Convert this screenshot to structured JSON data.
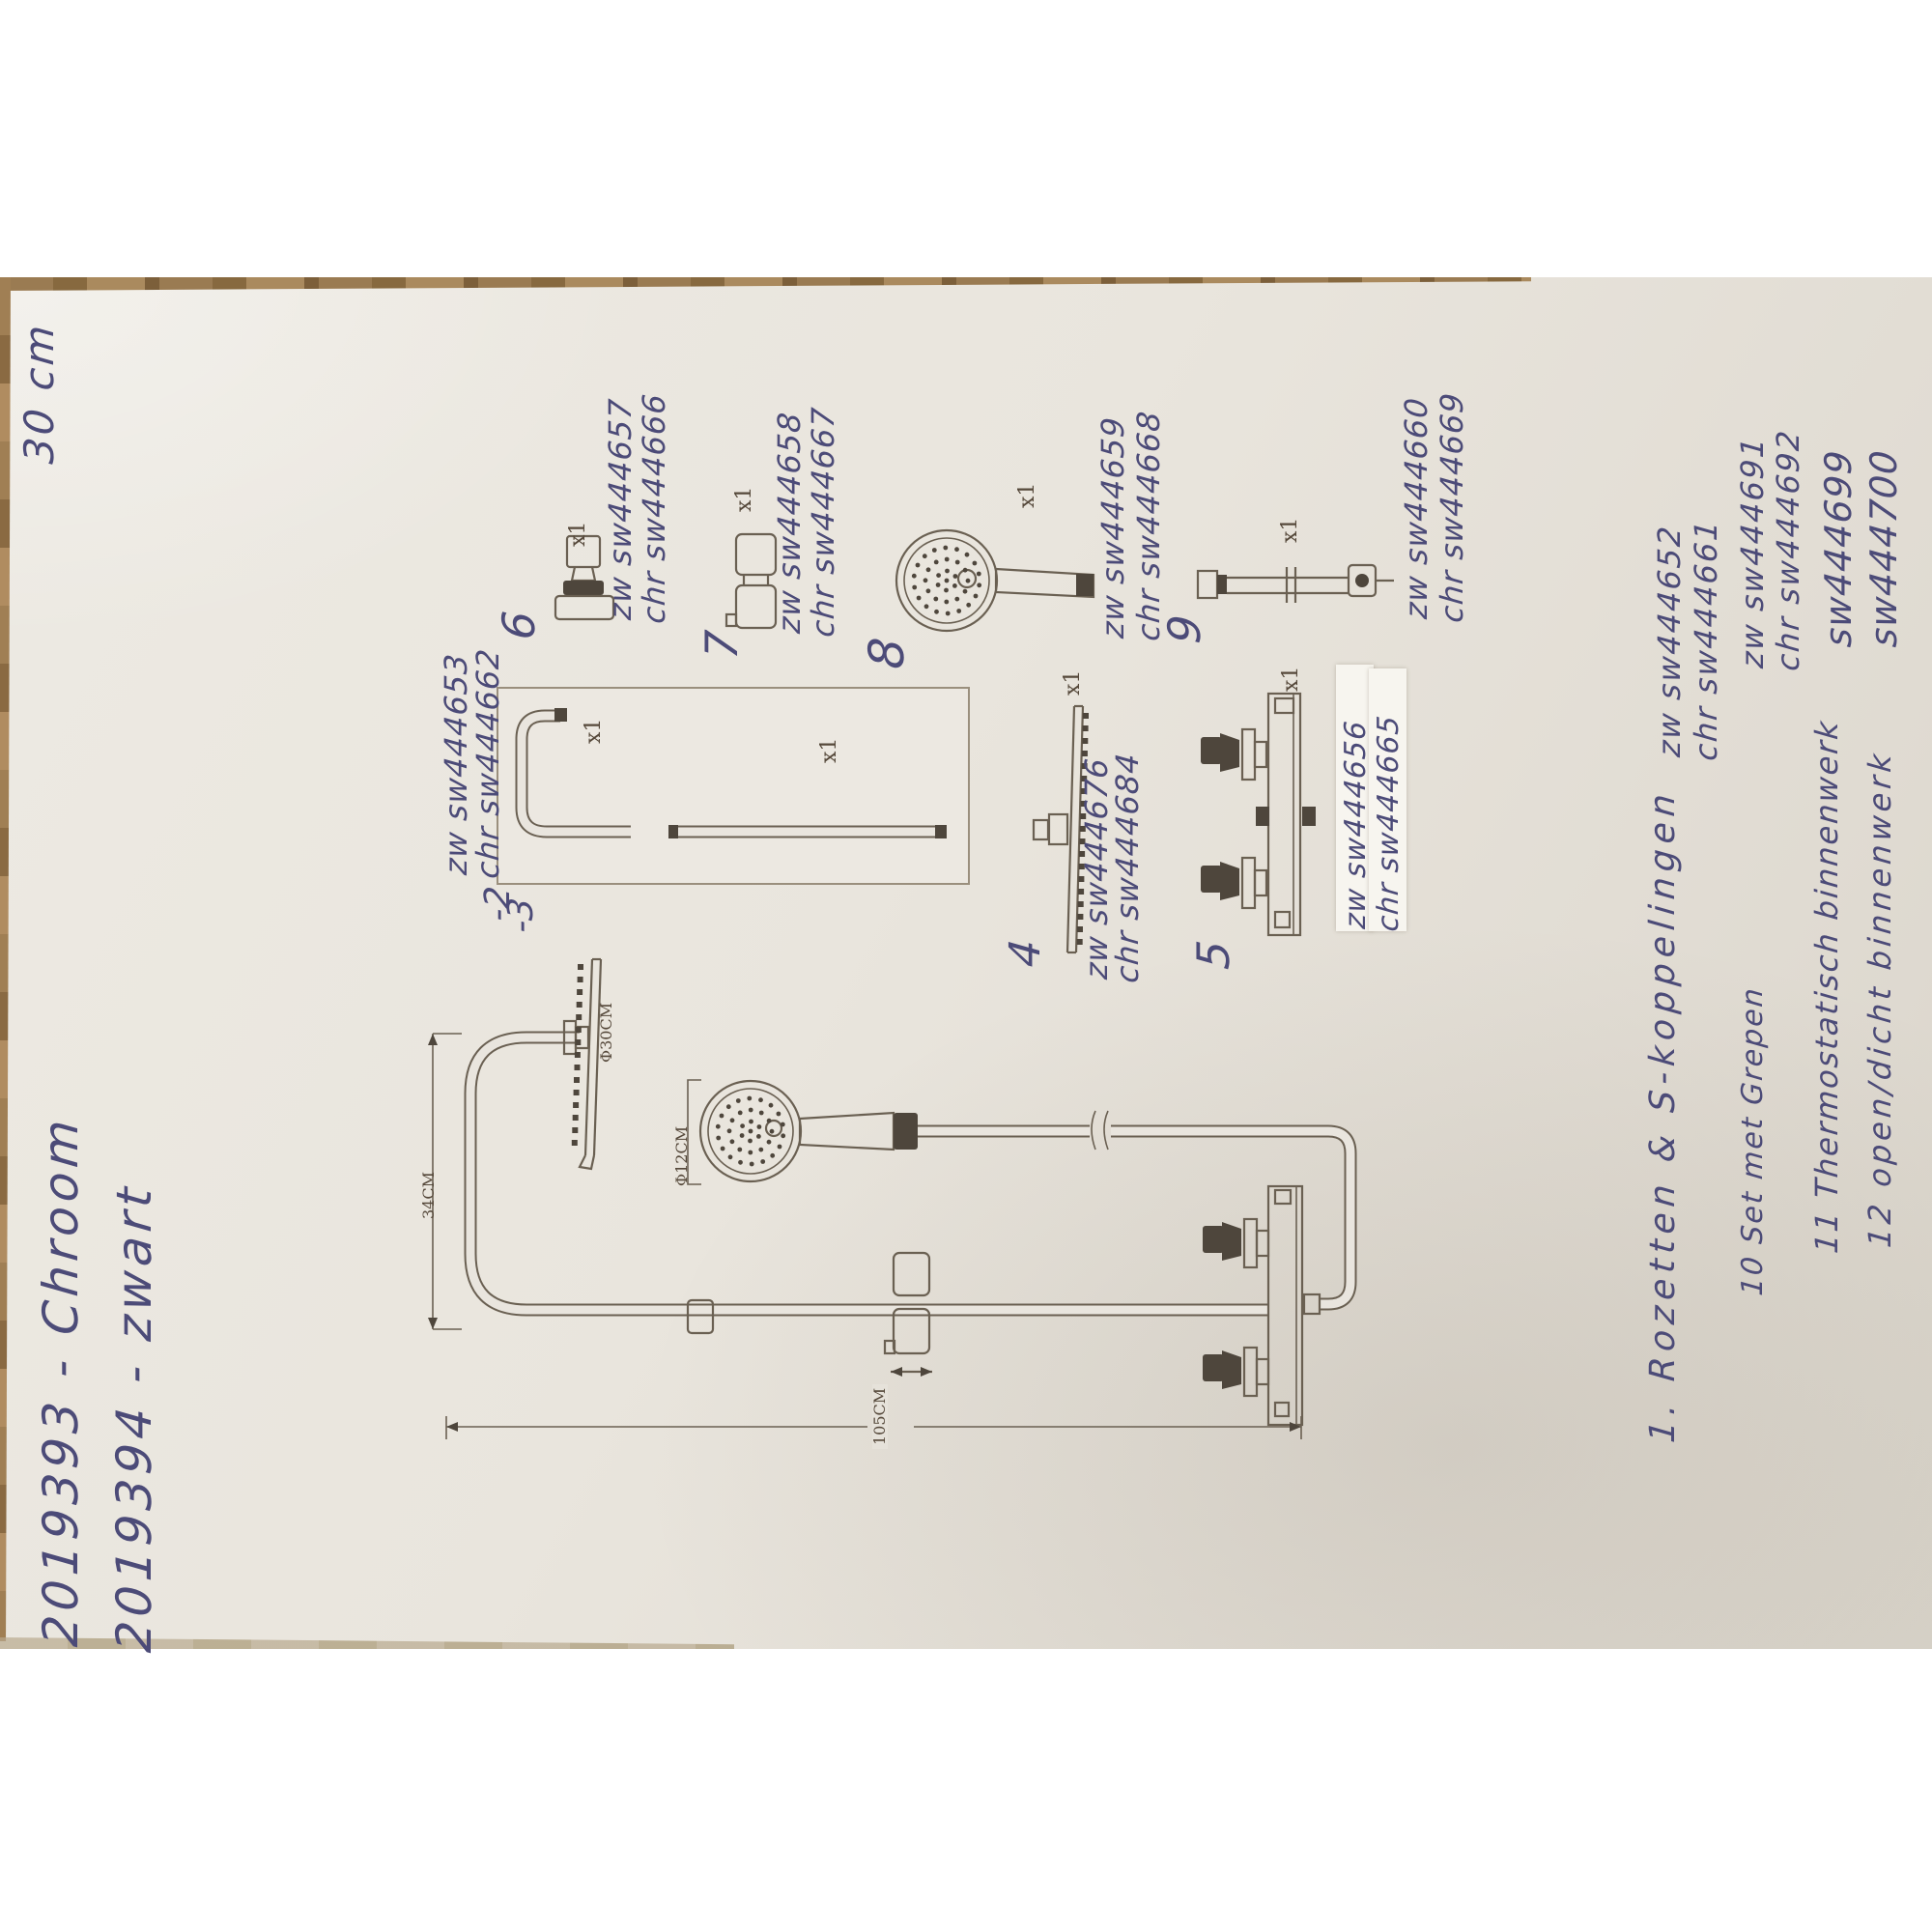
{
  "photo": {
    "corner_note": "30 cm"
  },
  "header_codes": {
    "chrome": "2019393 - Chroom",
    "black": "2019394 - zwart"
  },
  "qty_label": "x1",
  "parts": {
    "arm": {
      "label": "-2",
      "zw": "zw sw444653",
      "chr": "chr sw444662"
    },
    "bar": {
      "label": "-3"
    },
    "rainhead": {
      "label": "4",
      "zw": "zw sw444676",
      "chr": "chr sw444684"
    },
    "thermostat": {
      "label": "5",
      "zw": "zw sw444656",
      "chr": "chr sw444665"
    },
    "rosette": {
      "label": "6",
      "zw": "zw sw444657",
      "chr": "chr sw444666"
    },
    "slider": {
      "label": "7",
      "zw": "zw sw444658",
      "chr": "chr sw444667"
    },
    "handshower": {
      "label": "8",
      "zw": "zw sw444659",
      "chr": "chr sw444668"
    },
    "extension": {
      "label": "9",
      "zw": "zw sw444660",
      "chr": "chr sw444669"
    }
  },
  "list": {
    "item1": {
      "text": "1. Rozetten & S-koppelingen",
      "zw": "zw sw444652",
      "chr": "chr sw444661"
    },
    "item10": {
      "text": "10 Set met Grepen",
      "zw": "zw sw444691",
      "chr": "chr sw444692"
    },
    "item11": {
      "text": "11 Thermostatisch binnenwerk",
      "code": "sw444699"
    },
    "item12": {
      "text": "12 open/dicht binnenwerk",
      "code": "sw444700"
    }
  },
  "dimensions": {
    "arm_length": "34CM",
    "head_size": "Φ30CM",
    "hand_size": "Φ12CM",
    "column_height": "105CM"
  },
  "colors": {
    "ink": "#4c4b78",
    "print": "#5d5449",
    "paper": "#e8e4dc",
    "wood": "#9a7b52",
    "tape": "#f6f4ee"
  }
}
